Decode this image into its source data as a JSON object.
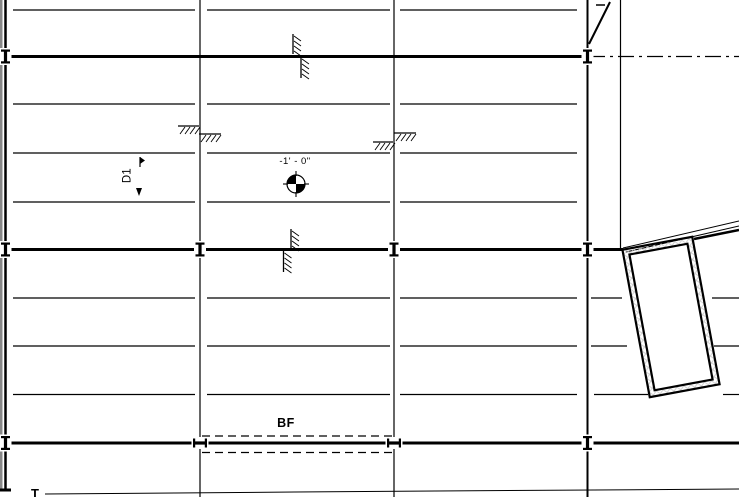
{
  "view": {
    "type": "structural-foundation-plan",
    "width": 739,
    "height": 497
  },
  "labels": {
    "spot_elevation": "-1' - 0\"",
    "deck_span_tag": "D1",
    "grade_beam_tag": "BF",
    "bottom_partial_tag": "T"
  },
  "colors": {
    "line": "#000000",
    "background": "#ffffff",
    "edge_strip": "#888888",
    "crosshatch": "#cccccc"
  },
  "drawing": {
    "edge_strip": {
      "x": 0,
      "y": 0,
      "w": 2.5,
      "h": 491
    },
    "v_lines": [
      {
        "name": "grid-line-left",
        "x": 5.5,
        "y1": 0,
        "y2": 490,
        "w": 2.5
      },
      {
        "name": "grid-line-b",
        "x": 200,
        "y1": 0,
        "y2": 497,
        "w": 1.2
      },
      {
        "name": "grid-line-c",
        "x": 394,
        "y1": 0,
        "y2": 497,
        "w": 1.2
      },
      {
        "name": "grid-line-d",
        "x": 587.5,
        "y1": 0,
        "y2": 497,
        "w": 2
      },
      {
        "name": "wall-line-right",
        "x": 620.5,
        "y1": 0,
        "y2": 249,
        "w": 1.2
      }
    ],
    "h_lines": [
      {
        "name": "joist-line",
        "y": 10,
        "w": 1.2,
        "segs": [
          [
            13,
            195
          ],
          [
            207,
            390
          ],
          [
            400,
            577
          ]
        ]
      },
      {
        "name": "foundation-wall",
        "y": 56.5,
        "w": 3,
        "segs": [
          [
            6,
            586
          ]
        ]
      },
      {
        "name": "joist-line",
        "y": 104,
        "w": 1.2,
        "segs": [
          [
            13,
            195
          ],
          [
            207,
            390
          ],
          [
            400,
            577
          ]
        ]
      },
      {
        "name": "joist-line",
        "y": 153,
        "w": 1.2,
        "segs": [
          [
            13,
            195
          ],
          [
            207,
            390
          ],
          [
            400,
            577
          ]
        ]
      },
      {
        "name": "joist-line",
        "y": 202,
        "w": 1.2,
        "segs": [
          [
            13,
            195
          ],
          [
            207,
            390
          ],
          [
            400,
            577
          ]
        ]
      },
      {
        "name": "foundation-wall",
        "y": 249.5,
        "w": 3,
        "segs": [
          [
            6,
            623
          ]
        ]
      },
      {
        "name": "joist-line",
        "y": 298,
        "w": 1.2,
        "segs": [
          [
            13,
            195
          ],
          [
            207,
            390
          ],
          [
            400,
            577
          ],
          [
            591,
            622
          ],
          [
            712,
            739
          ]
        ]
      },
      {
        "name": "joist-line",
        "y": 346,
        "w": 1.2,
        "segs": [
          [
            13,
            195
          ],
          [
            207,
            390
          ],
          [
            400,
            577
          ],
          [
            591,
            627
          ],
          [
            714,
            739
          ]
        ]
      },
      {
        "name": "joist-line",
        "y": 394.5,
        "w": 1.2,
        "segs": [
          [
            13,
            195
          ],
          [
            207,
            390
          ],
          [
            400,
            577
          ],
          [
            594,
            648
          ],
          [
            723,
            739
          ]
        ]
      },
      {
        "name": "foundation-wall",
        "y": 443,
        "w": 3,
        "segs": [
          [
            6,
            739
          ]
        ]
      },
      {
        "name": "wall-stub",
        "y": 490,
        "w": 3,
        "segs": [
          [
            0,
            11
          ]
        ]
      }
    ],
    "dash_dot": {
      "name": "centerline",
      "y": 56.5,
      "x1": 589,
      "x2": 739,
      "w": 1.3,
      "dash": "16 5 3 5"
    },
    "dashed_lines": [
      {
        "name": "hidden-footing-edge",
        "y": 436,
        "x1": 202,
        "x2": 392,
        "w": 1.3,
        "dash": "8 5"
      },
      {
        "name": "hidden-footing-edge",
        "y": 452.5,
        "x1": 202,
        "x2": 392,
        "w": 1.3,
        "dash": "8 5"
      }
    ],
    "diagonals": [
      {
        "name": "roof-edge",
        "x1": 589,
        "y1": 44,
        "x2": 610,
        "y2": 2,
        "w": 2
      },
      {
        "name": "roof-edge-dash",
        "x1": 596,
        "y1": 5,
        "x2": 605,
        "y2": 5,
        "w": 1.5
      },
      {
        "name": "ramp-edge",
        "x1": 623,
        "y1": 248,
        "x2": 739,
        "y2": 221,
        "w": 1
      },
      {
        "name": "ramp-edge",
        "x1": 626,
        "y1": 252,
        "x2": 739,
        "y2": 226,
        "w": 1
      },
      {
        "name": "wall-edge-thick",
        "x1": 694,
        "y1": 239,
        "x2": 739,
        "y2": 230,
        "w": 2.5
      },
      {
        "name": "grade-line",
        "x1": 45,
        "y1": 494,
        "x2": 295,
        "y2": 492,
        "w": 1
      },
      {
        "name": "grade-line",
        "x1": 295,
        "y1": 492,
        "x2": 739,
        "y2": 489,
        "w": 1
      }
    ],
    "earth_hatches": {
      "horizontal": [
        {
          "x": 178,
          "y": 126,
          "w": 21,
          "h": 8
        },
        {
          "x": 199,
          "y": 134,
          "w": 22,
          "h": 8
        },
        {
          "x": 373,
          "y": 142,
          "w": 20,
          "h": 8
        },
        {
          "x": 394,
          "y": 133,
          "w": 22,
          "h": 8
        }
      ],
      "vertical": [
        {
          "x": 293,
          "y": 34,
          "w": 8,
          "h": 20
        },
        {
          "x": 301,
          "y": 57,
          "w": 8,
          "h": 21
        },
        {
          "x": 291,
          "y": 229,
          "w": 8,
          "h": 20
        },
        {
          "x": 283.5,
          "y": 251,
          "w": 8,
          "h": 21
        }
      ]
    },
    "grid_ticks": {
      "vertical": [
        {
          "x": 5.5,
          "y": 56.5
        },
        {
          "x": 587.5,
          "y": 56.5
        },
        {
          "x": 5.5,
          "y": 249.5
        },
        {
          "x": 200,
          "y": 249.5
        },
        {
          "x": 394,
          "y": 249.5
        },
        {
          "x": 587.5,
          "y": 249.5
        },
        {
          "x": 5.5,
          "y": 443
        },
        {
          "x": 587.5,
          "y": 443
        }
      ],
      "horizontal": [
        {
          "x": 200,
          "y": 443
        },
        {
          "x": 394,
          "y": 443
        }
      ]
    },
    "spot_symbol": {
      "cx": 296,
      "cy": 184,
      "r": 9
    },
    "opening": {
      "cx": 671,
      "cy": 317,
      "w": 71,
      "h": 150,
      "angle": -10.5,
      "inset": 6
    },
    "d1_arrows": [
      {
        "type": "flag",
        "x": 140,
        "y1": 157,
        "y2": 167
      },
      {
        "type": "head-down",
        "points": "136,188 142,188 139,196"
      }
    ]
  }
}
